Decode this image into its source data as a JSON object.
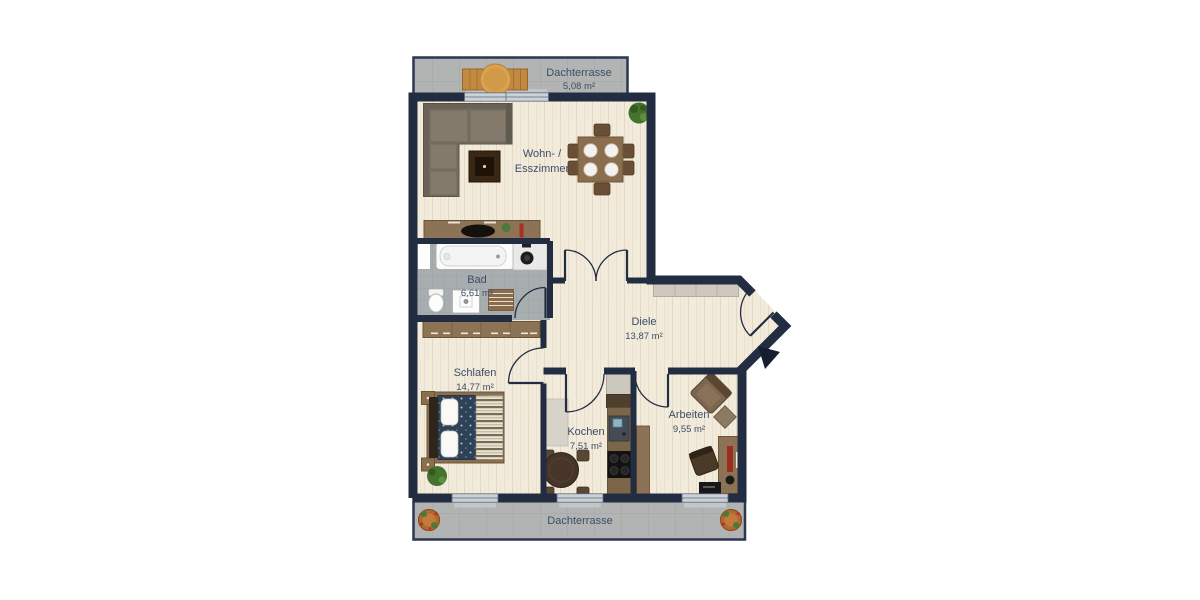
{
  "plan": {
    "rooms": {
      "terrace_top": {
        "name": "Dachterrasse",
        "area": "5,08 m²"
      },
      "living": {
        "name1": "Wohn- /",
        "name2": "Esszimmer"
      },
      "bath": {
        "name": "Bad",
        "area": "6,61 m²"
      },
      "hall": {
        "name": "Diele",
        "area": "13,87 m²"
      },
      "bedroom": {
        "name": "Schlafen",
        "area": "14,77 m²"
      },
      "kitchen": {
        "name": "Kochen",
        "area": "7,51 m²"
      },
      "office": {
        "name": "Arbeiten",
        "area": "9,55 m²"
      },
      "terrace_bottom": {
        "name": "Dachterrasse"
      }
    },
    "colors": {
      "wall": "#222d42",
      "wood_floor": "#f2ebdb",
      "bath_tile": "#a8adb0",
      "terrace_tile": "#b1b4b2",
      "label_text": "#3d4d68",
      "furniture_wood": "#8d7355",
      "sofa": "#7a7164",
      "bed_duvet": "#2d4157",
      "accent_red": "#a82f22",
      "plant_green": "#44722f"
    }
  }
}
